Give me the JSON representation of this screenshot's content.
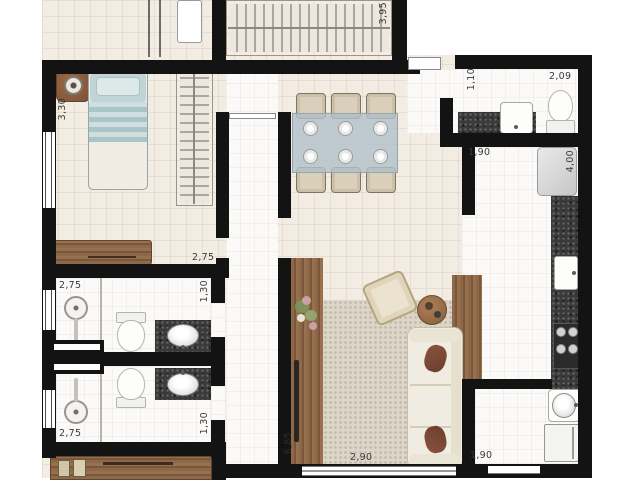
{
  "plan_title": "apartment floor plan",
  "palette": {
    "wall": "#131313",
    "floor": "#f2ece3",
    "tile": "#fbfaf8",
    "granite": "#3a3a3a",
    "wood": "#8d6849",
    "bed_blue": "#b7cdd0",
    "cushion_brown": "#7d4a38"
  },
  "dimensions": [
    {
      "id": "bedroom1-height",
      "text": "3,30",
      "orientation": "vertical"
    },
    {
      "id": "top-closet-width",
      "text": "3,95",
      "orientation": "vertical"
    },
    {
      "id": "entry-passage",
      "text": "1,10",
      "orientation": "vertical"
    },
    {
      "id": "lavabo-width",
      "text": "2,09",
      "orientation": "horizontal"
    },
    {
      "id": "kitchen-width",
      "text": "1,90",
      "orientation": "horizontal"
    },
    {
      "id": "kitchen-depth",
      "text": "4,00",
      "orientation": "vertical"
    },
    {
      "id": "bath-block-width",
      "text": "2,75",
      "orientation": "horizontal"
    },
    {
      "id": "bath1-width",
      "text": "2,75",
      "orientation": "horizontal"
    },
    {
      "id": "bath1-depth",
      "text": "1,30",
      "orientation": "vertical"
    },
    {
      "id": "bath2-width",
      "text": "2,75",
      "orientation": "horizontal"
    },
    {
      "id": "bath2-depth",
      "text": "1,30",
      "orientation": "vertical"
    },
    {
      "id": "living-depth",
      "text": "6,85",
      "orientation": "vertical"
    },
    {
      "id": "living-width",
      "text": "2,90",
      "orientation": "horizontal"
    },
    {
      "id": "laundry-width",
      "text": "1,90",
      "orientation": "horizontal"
    }
  ]
}
